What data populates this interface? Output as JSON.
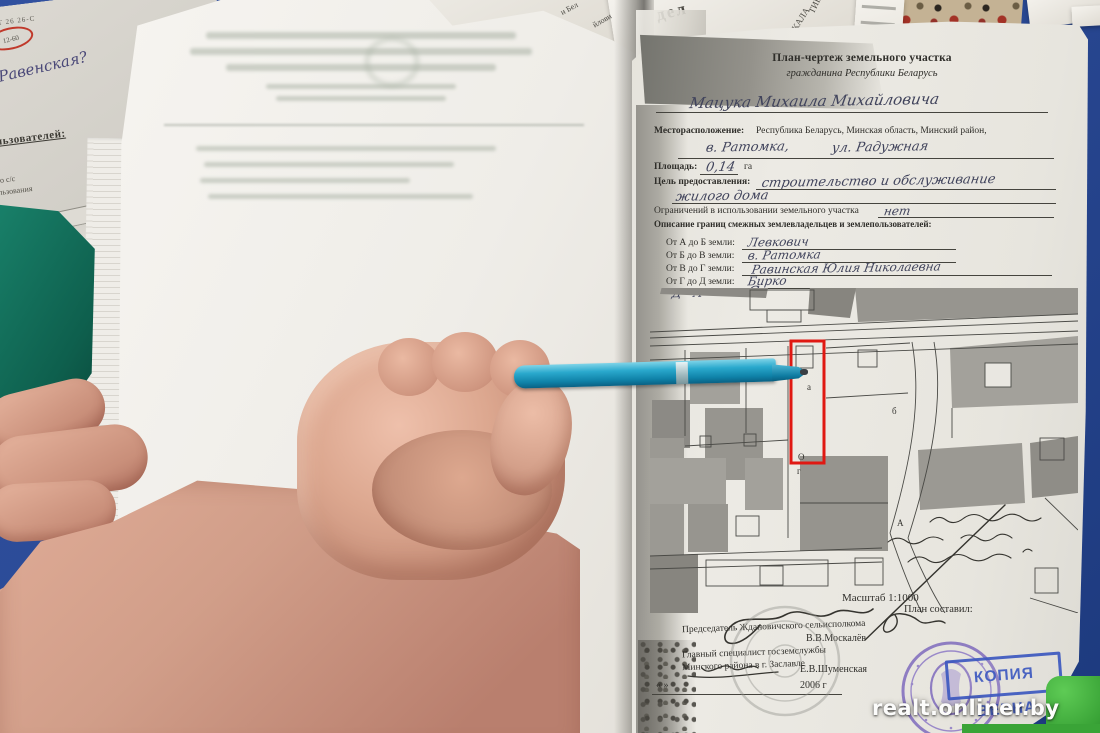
{
  "watermark": "realt.onliner.by",
  "colors": {
    "table_blue": "#2b4a96",
    "fabric_green": "#0e5f4d",
    "bright_green": "#3aa437",
    "pen_teal": "#1ba7cc",
    "highlight_red": "#e01812",
    "stamp_purple": "#7f6bbd",
    "stamp_blue": "#3d59c0",
    "red_oval": "#c0392b"
  },
  "top_left_doc": {
    "code": "ШТ 26 26-С",
    "circled_value": "12-60",
    "red_handwriting": "Равенская?",
    "heading_fragment": "ользователей:",
    "small_fragment1": "го с/с",
    "small_fragment2": "льзования"
  },
  "top_papers": {
    "frag_del": "дел",
    "frag_kala": "КАЛА",
    "frag_tie": "ТИЕ",
    "frag_bel": "и Бел",
    "frag_ilovi": "йлови",
    "frag_per": "пер."
  },
  "plan": {
    "title_line1": "План-чертеж земельного участка",
    "title_line2": "гражданина Республики Беларусь",
    "owner_name": "Мацука  Михаила  Михайловича",
    "location_label": "Месторасположение:",
    "location_printed": "Республика  Беларусь,   Минская   область,   Минский   район,",
    "location_written_1": "в. Ратомка,",
    "location_written_2": "ул. Радужная",
    "area_label": "Площадь:",
    "area_value": "0,14",
    "area_unit": "га",
    "purpose_label": "Цель предоставления:",
    "purpose_line1": "строительство  и  обслуживание",
    "purpose_line2": "жилого  дома",
    "restrictions_label": "Ограничений в использовании земельного участка",
    "restrictions_value": "нет",
    "boundaries_heading": "Описание границ смежных землевладельцев и землепользователей:",
    "boundaries": [
      {
        "label": "От А до Б земли:",
        "value": "Левкович"
      },
      {
        "label": "От Б до В земли:",
        "value": "в. Ратомка"
      },
      {
        "label": "От В до Г земли:",
        "value": "Равинская  Юлия  Николаевна"
      },
      {
        "label": "От Г до Д земли:",
        "value": "Бирко"
      }
    ],
    "d_a_note": "Д - А",
    "c_note": "С",
    "map_marks": {
      "m1": "а",
      "m2": "О",
      "m3": "г",
      "m4": "б",
      "m5": "А"
    },
    "scale": "Масштаб 1:1000",
    "author_label": "План составил:",
    "chairman_title": "Председатель Ждановичского сельисполкома",
    "chairman_name": "В.В.Москалёв",
    "specialist_title1": "Главный специалист госземслужбы",
    "specialist_title2": "Минского района в г. Заславле",
    "specialist_name": "Е.В.Шуменская",
    "date_quotes": "«      »",
    "date_year": "2006 г",
    "copy_stamp_text": "КОПИЯ ВЕРНА"
  }
}
